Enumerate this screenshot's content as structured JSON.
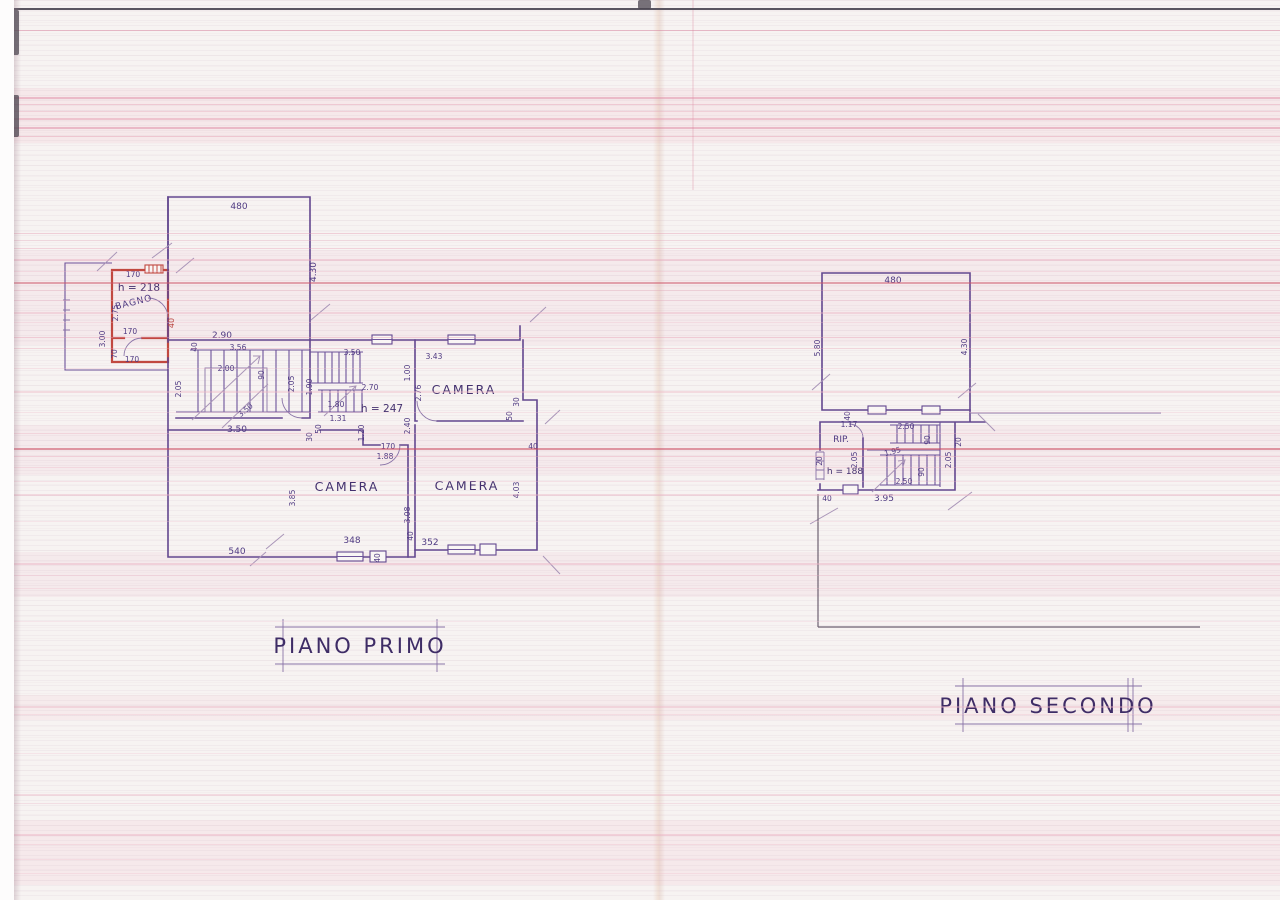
{
  "titles": {
    "primo": "PIANO PRIMO",
    "secondo": "PIANO SECONDO"
  },
  "colors": {
    "ink": "#63478f",
    "red_room": "#c14840",
    "scan_line": "#d65a78"
  },
  "pp": {
    "room_bagno": "BAGNO",
    "room_camera_top_right": "CAMERA",
    "room_camera_bottom_left": "CAMERA",
    "room_camera_bottom_right": "CAMERA",
    "h_bagno": "h = 218",
    "h_hall": "h = 247",
    "d": {
      "t480": "480",
      "r430": "4.30",
      "bag_top": "170",
      "bag_l275": "2.75",
      "bag_l300": "3.00",
      "bag_r40": "40",
      "bag_mid170": "170",
      "bag_l70": "70",
      "bag_bot170": "170",
      "hall_40": "40",
      "hall_290": "2.90",
      "st_356": "3.56",
      "st_200": "2.00",
      "st_90": "90",
      "st_350d": "3.50",
      "cor_350": "3.50",
      "cor_205": "2.05",
      "c_205": "2.05",
      "c_190": "1.90",
      "c_350": "3.50",
      "c_270": "2.70",
      "c_180": "1.80",
      "c_131": "1.31",
      "c_50": "50",
      "c_30": "30",
      "c_120": "1.20",
      "c_240": "2.40",
      "c_170": "170",
      "c_188": "1.88",
      "tr_343": "3.43",
      "tr_100": "1.00",
      "tr_276": "2.76",
      "tr_30": "30",
      "tr_50": "50",
      "tr_40": "40",
      "bl_385": "3.85",
      "bl_308": "3.08",
      "bl_40": "40",
      "bl_348": "348",
      "br_352": "352",
      "br_403": "4.03",
      "bot_540": "540",
      "sill_40": "40"
    }
  },
  "ps": {
    "room_rip": "RIP.",
    "h_rip": "h = 188",
    "d": {
      "t480": "480",
      "l580": "5.80",
      "r430": "4.30",
      "rip_117": "1.17",
      "rip_40": "40",
      "rip_20": "20",
      "st_250t": "2.50",
      "st_90a": "90",
      "st_195": "1.95",
      "st_205": "2.05",
      "st_90b": "90",
      "st_250b": "2.50",
      "out_205": "2.05",
      "out_20": "20",
      "bot_395": "3.95",
      "bot_40": "40"
    }
  }
}
